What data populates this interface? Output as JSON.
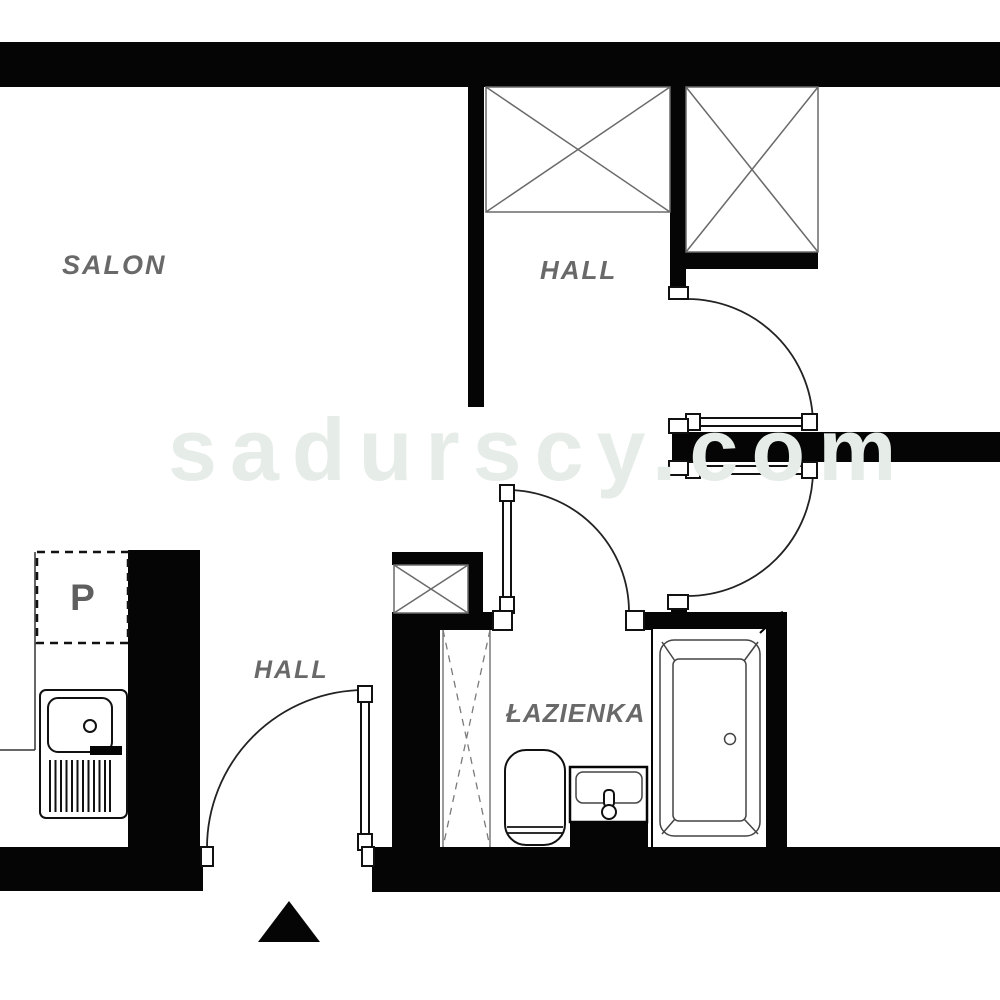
{
  "watermark": {
    "text": "sadurscy.com",
    "color": "#e6ece7"
  },
  "labels": {
    "salon": "SALON",
    "hall_top": "HALL",
    "hall_bottom": "HALL",
    "bathroom": "ŁAZIENKA",
    "storage": "P"
  },
  "colors": {
    "wall": "#050505",
    "background": "#ffffff",
    "room_label": "#696969",
    "wardrobe_line": "#6a6a6a",
    "fixture_line": "#444444",
    "watermark": "#e6ece7"
  },
  "icons": {
    "wardrobe_symbol": "crossed-box",
    "shaft_symbol": "crossed-box",
    "tall_cabinet_symbol": "dashed-crossed-box",
    "entrance_marker": "filled-triangle-up",
    "door_swing": "quarter-arc-with-leaf"
  }
}
